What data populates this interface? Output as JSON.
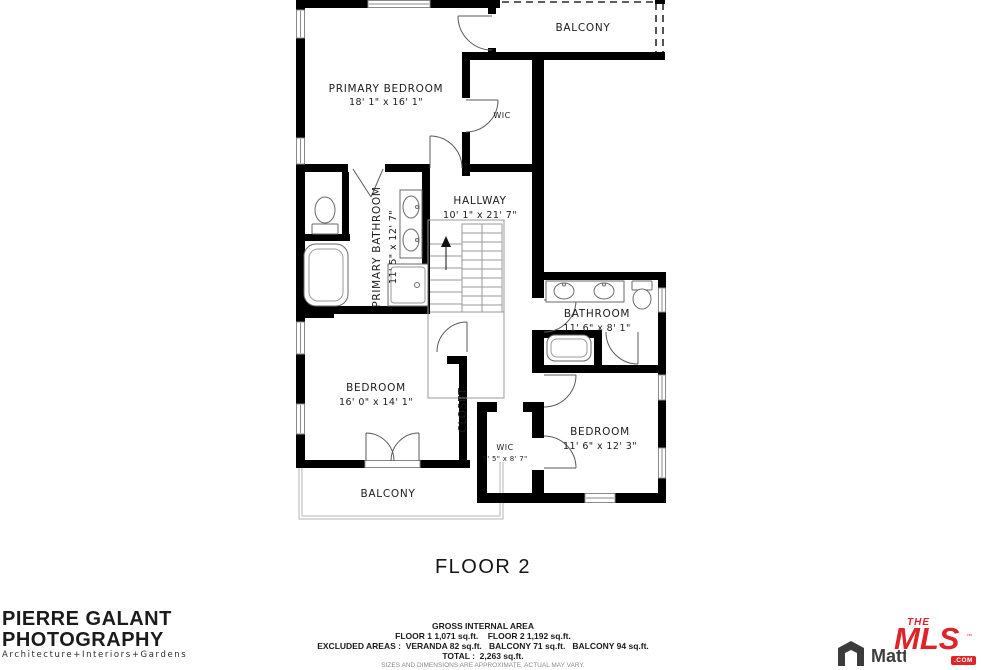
{
  "floorplan": {
    "title": "FLOOR 2",
    "rooms": {
      "balcony_top": {
        "name": "BALCONY"
      },
      "primary_bedroom": {
        "name": "PRIMARY BEDROOM",
        "dims": "18' 1\" x 16' 1\""
      },
      "wic_top": {
        "name": "WIC"
      },
      "hallway": {
        "name": "HALLWAY",
        "dims": "10' 1\" x 21' 7\""
      },
      "primary_bathroom": {
        "name": "PRIMARY BATHROOM",
        "dims": "11' 5\" x 12' 7\""
      },
      "bathroom": {
        "name": "BATHROOM",
        "dims": "11' 6\" x 8' 1\""
      },
      "bedroom_left": {
        "name": "BEDROOM",
        "dims": "16' 0\" x 14' 1\""
      },
      "closet": {
        "name": "CLOSET"
      },
      "wic_bottom": {
        "name": "WIC",
        "dims": "5' 5\" x 8' 7\""
      },
      "bedroom_right": {
        "name": "BEDROOM",
        "dims": "11' 6\" x 12' 3\""
      },
      "balcony_bottom": {
        "name": "BALCONY"
      }
    },
    "area_summary": {
      "heading": "GROSS INTERNAL AREA",
      "floors_line": "FLOOR 1 1,071 sq.ft.    FLOOR 2 1,192 sq.ft.",
      "excluded_line": "EXCLUDED AREAS :  VERANDA 82 sq.ft.   BALCONY 71 sq.ft.   BALCONY 94 sq.ft.",
      "total_line": "TOTAL :  2,263 sq.ft.",
      "disclaimer": "SIZES AND DIMENSIONS ARE APPROXIMATE, ACTUAL MAY VARY."
    }
  },
  "branding": {
    "photographer": {
      "name_line1": "PIERRE GALANT",
      "name_line2": "PHOTOGRAPHY",
      "tagline": "Architecture+Interiors+Gardens"
    },
    "matterport": {
      "label": "Matterport"
    },
    "mls": {
      "the": "THE",
      "mls": "MLS",
      "tm": "™",
      "com": ".COM"
    }
  },
  "colors": {
    "wall": "#000000",
    "mls_red": "#e02328",
    "matterport_gray": "#3d3d3d"
  }
}
